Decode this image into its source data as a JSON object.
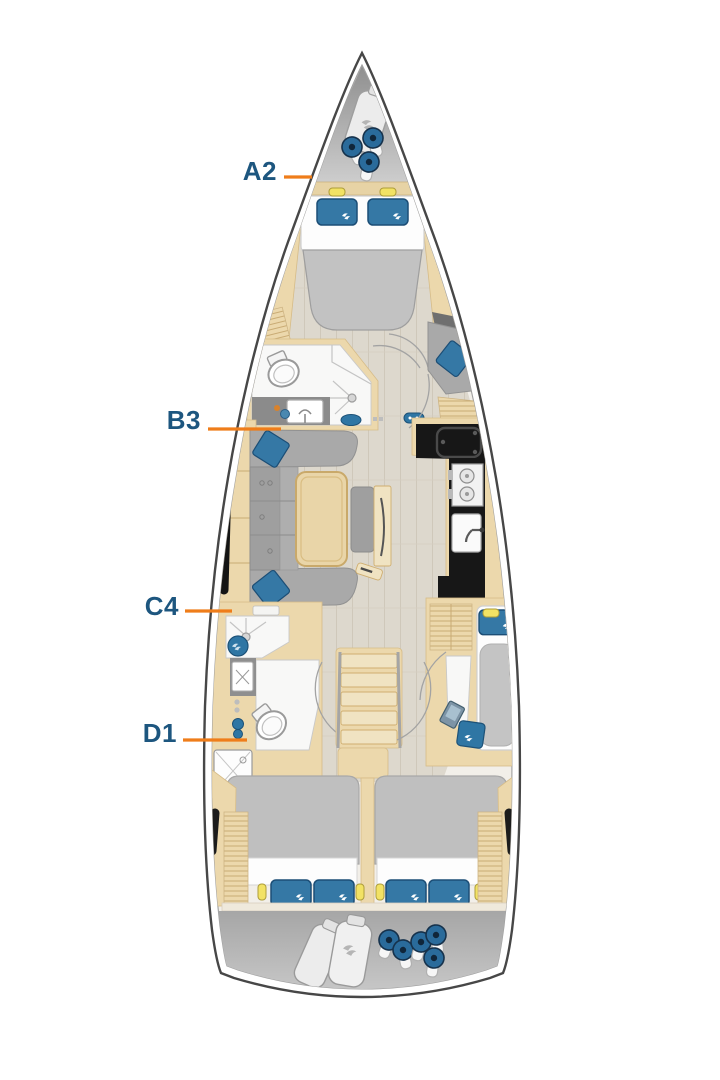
{
  "plan": {
    "title_semantic": "sailing-yacht-interior-layout-plan",
    "labels": [
      {
        "text": "A2"
      },
      {
        "text": "B3"
      },
      {
        "text": "C4"
      },
      {
        "text": "D1"
      }
    ],
    "colors": {
      "label_navy": "#1d567f",
      "leader_orange": "#ef7d1a",
      "accent_blue": "#2f76a4",
      "pillow_blue": "#3578a5",
      "wood_beige": "#ecd8ac",
      "counter_black": "#171717",
      "furniture_gray": "#a9a9a9",
      "deck_gray": "#b2b2b2",
      "floor_plank": "#ddd8cd",
      "interior_cream": "#f2efe9",
      "light_yellow": "#f2e264"
    },
    "icons": [
      "fender-icon",
      "fender-bag-icon",
      "pillow-icon",
      "reading-light-icon",
      "toilet-icon",
      "sink-icon",
      "shower-icon",
      "stove-icon",
      "galley-sink-icon",
      "table-icon",
      "stairs-icon",
      "laptop-icon",
      "washer-locker-icon",
      "hull-window-icon"
    ]
  }
}
